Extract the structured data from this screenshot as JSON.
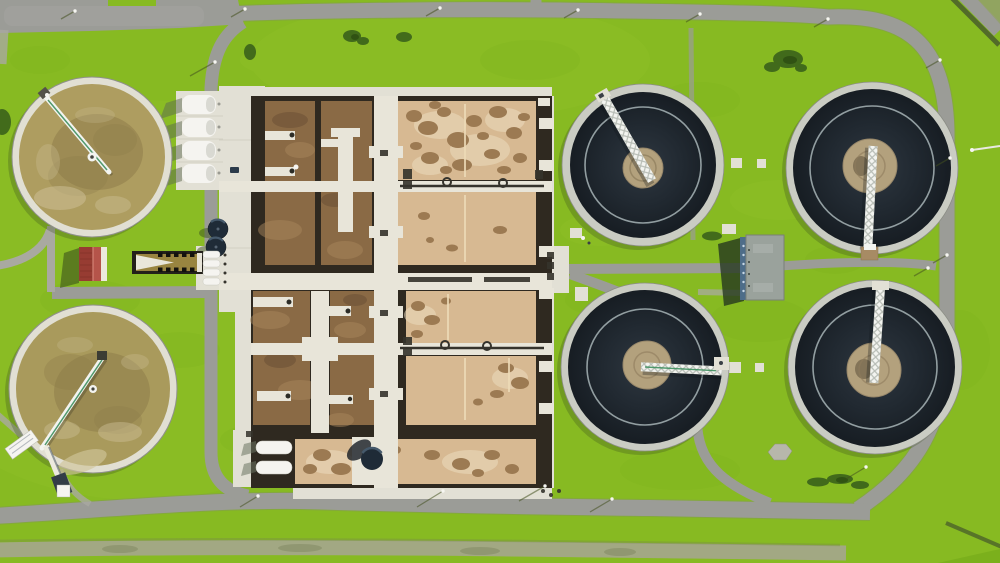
{
  "scene": {
    "type": "aerial-photograph",
    "subject": "Top-down drone view of a wastewater treatment plant on bright green grass",
    "features": {
      "dark_secondary_clarifiers": 4,
      "brown_sludge_ponds": 2,
      "aeration_basin_block": 1,
      "white_storage_tanks": 4,
      "small_digester_tanks": 2,
      "buildings": [
        "red-roof-shed",
        "gray-roof-operations-building"
      ],
      "roads": [
        "top-road",
        "right-ring-road",
        "bottom-road",
        "left-service-road",
        "center-footpaths"
      ]
    }
  },
  "colors": {
    "grass": "#87ba22",
    "grass_dark": "#6da317",
    "grass_light": "#9ecd32",
    "road": "#9b9c97",
    "road_edge": "#7f817b",
    "path": "#a9a9a1",
    "concrete": "#e2e0d5",
    "walkway": "#e8e5d9",
    "concrete_shadow": "#c6c4b8",
    "basin_wall": "#2f2920",
    "basin_dark_brown": "#8a6a45",
    "basin_brown_light": "#a8865c",
    "basin_brown_dark": "#5f4630",
    "basin_tan": "#d7b992",
    "basin_speckle": "#9c7a52",
    "speckle_haze": "#ecddbf",
    "dark_water_edge": "#171d23",
    "dark_water_mid": "#212931",
    "dark_water_center": "#2e3740",
    "clarifier_rim": "#caccc3",
    "inner_ring": "#a7b4b6",
    "center_well": "#b3a17d",
    "well_swirl": "#8d7c5b",
    "bridge_white": "#f3f4f0",
    "bridge_green": "#3e8f5e",
    "truss_gray": "#aab0a8",
    "pond_water": "#ae9d60",
    "pond_water2": "#a99a5c",
    "pond_sludge": "#8b7a48",
    "pond_light": "#cfc29a",
    "tank_white": "#f5f4f0",
    "shadow_green": "#3c511d",
    "red_roof": "#973c32",
    "red_roof_light": "#b5544a",
    "gray_roof": "#9aa29c",
    "blue_wall": "#4e6d89",
    "digester_dark": "#1f2b37",
    "digester_light": "#45596b",
    "pipe_dark": "#35332c",
    "channel_water": "#998540",
    "ditch": "#a2a883",
    "hedge": "#4c632a",
    "car_dark": "#2b3b4b",
    "lamp_white": "#f6f6f1"
  }
}
